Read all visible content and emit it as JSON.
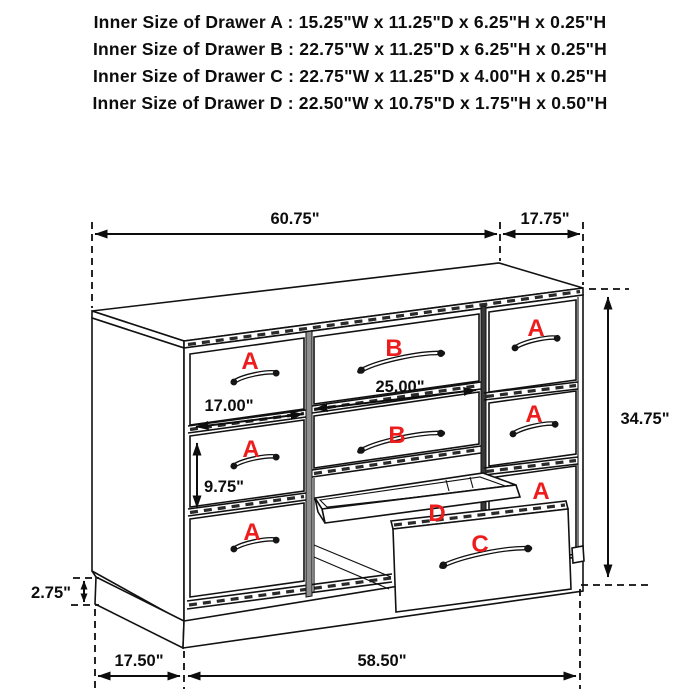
{
  "header": {
    "lines": [
      "Inner Size of Drawer A : 15.25\"W x 11.25\"D x 6.25\"H x 0.25\"H",
      "Inner Size of Drawer B : 22.75\"W x 11.25\"D x 6.25\"H x 0.25\"H",
      "Inner Size of Drawer C : 22.75\"W x 11.25\"D x 4.00\"H x 0.25\"H",
      "Inner Size of Drawer D : 22.50\"W x 10.75\"D x 1.75\"H x 0.50\"H"
    ]
  },
  "dimensions": {
    "top_width": "60.75\"",
    "top_depth": "17.75\"",
    "overall_height": "34.75\"",
    "left_opening_width": "17.00\"",
    "middle_opening_width": "25.00\"",
    "drawer_opening_height": "9.75\"",
    "base_height": "2.75\"",
    "base_depth": "17.50\"",
    "base_width": "58.50\""
  },
  "drawer_labels": {
    "a": "A",
    "b": "B",
    "c": "C",
    "d": "D"
  },
  "colors": {
    "label_red": "#ed1c1d",
    "line_black": "#111111"
  }
}
